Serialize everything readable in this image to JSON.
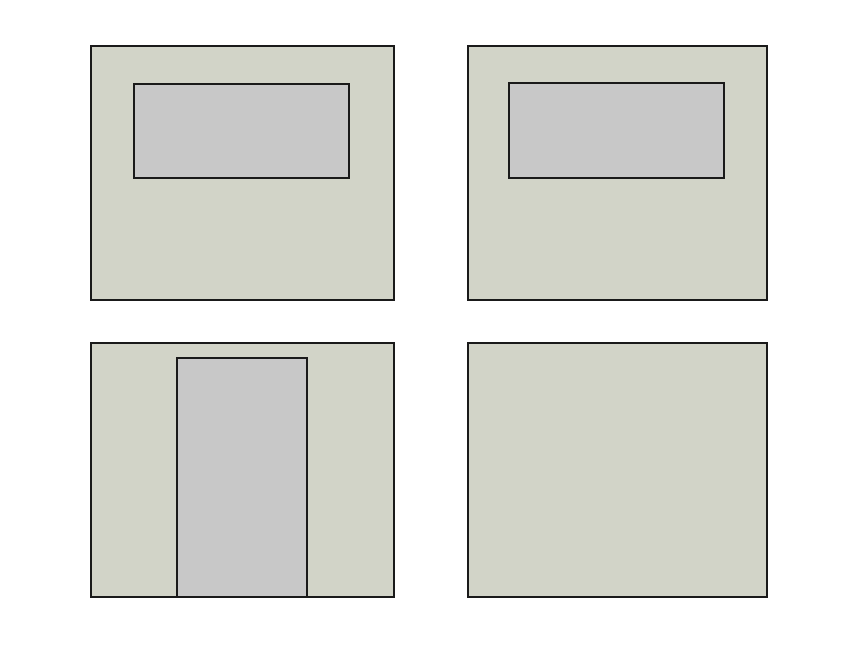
{
  "canvas": {
    "width": 860,
    "height": 645,
    "background": "#ffffff"
  },
  "colors": {
    "wall_fill": "#d2d4c8",
    "opening_fill": "#c8c8c8",
    "outline": "#1a1a1a"
  },
  "diagram": {
    "type": "panel-layout",
    "description": "Four rectangular wall panels in a 2x2 grid: two with window openings, one with a door opening, one plain",
    "panels": [
      {
        "name": "wall-panel-top-left-window",
        "kind": "wall-with-window",
        "x": 90,
        "y": 45,
        "w": 305,
        "h": 256,
        "opening": {
          "name": "window-opening-left",
          "kind": "window",
          "x": 133,
          "y": 83,
          "w": 217,
          "h": 96
        }
      },
      {
        "name": "wall-panel-top-right-window",
        "kind": "wall-with-window",
        "x": 467,
        "y": 45,
        "w": 301,
        "h": 256,
        "opening": {
          "name": "window-opening-right",
          "kind": "window",
          "x": 508,
          "y": 82,
          "w": 217,
          "h": 97
        }
      },
      {
        "name": "wall-panel-bottom-left-door",
        "kind": "wall-with-door",
        "x": 90,
        "y": 342,
        "w": 305,
        "h": 256,
        "opening": {
          "name": "door-opening",
          "kind": "door",
          "x": 176,
          "y": 357,
          "w": 132,
          "h": 241
        }
      },
      {
        "name": "wall-panel-bottom-right-plain",
        "kind": "plain-wall",
        "x": 467,
        "y": 342,
        "w": 301,
        "h": 256,
        "opening": null
      }
    ]
  }
}
